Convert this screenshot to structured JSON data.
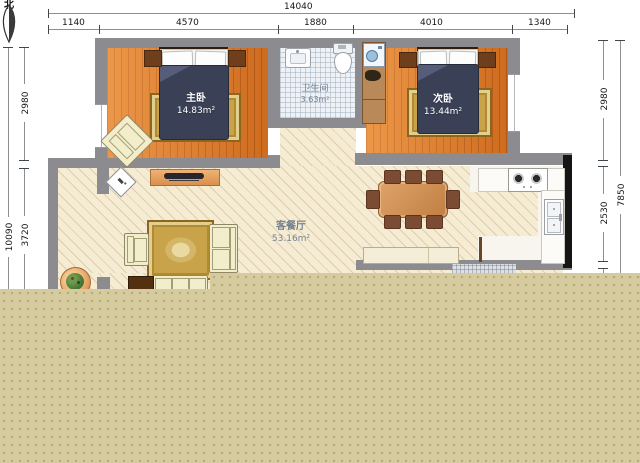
{
  "compass": {
    "north_label": "北"
  },
  "dimensions": {
    "top": {
      "overall": "14040",
      "segments": [
        "1140",
        "4570",
        "1880",
        "4010",
        "1340"
      ]
    },
    "left": {
      "overall": "10090",
      "segments": [
        "2980",
        "3720"
      ]
    },
    "right": {
      "overall": "7850",
      "segments": [
        "2980",
        "2530"
      ]
    }
  },
  "rooms": {
    "master_bedroom": {
      "name": "主卧",
      "area": "14.83m²"
    },
    "bathroom": {
      "name": "卫生间",
      "area": "3.63m²"
    },
    "second_bedroom": {
      "name": "次卧",
      "area": "13.44m²"
    },
    "living_dining": {
      "name": "客餐厅",
      "area": "53.16m²"
    }
  },
  "colors": {
    "wall": "#8b8b90",
    "black_wall": "#151515",
    "wood_floor": "#e07a28",
    "living_floor": "#f5ecd3",
    "tile_floor": "#eef1f5",
    "overlay_tan": "#d6cb9e",
    "bed_duvet": "#3a4157",
    "rug_gold": "#c9a34a",
    "dining_table": "#cf9258",
    "dining_chair": "#7c4b34",
    "sofa_cream": "#f2edca"
  }
}
